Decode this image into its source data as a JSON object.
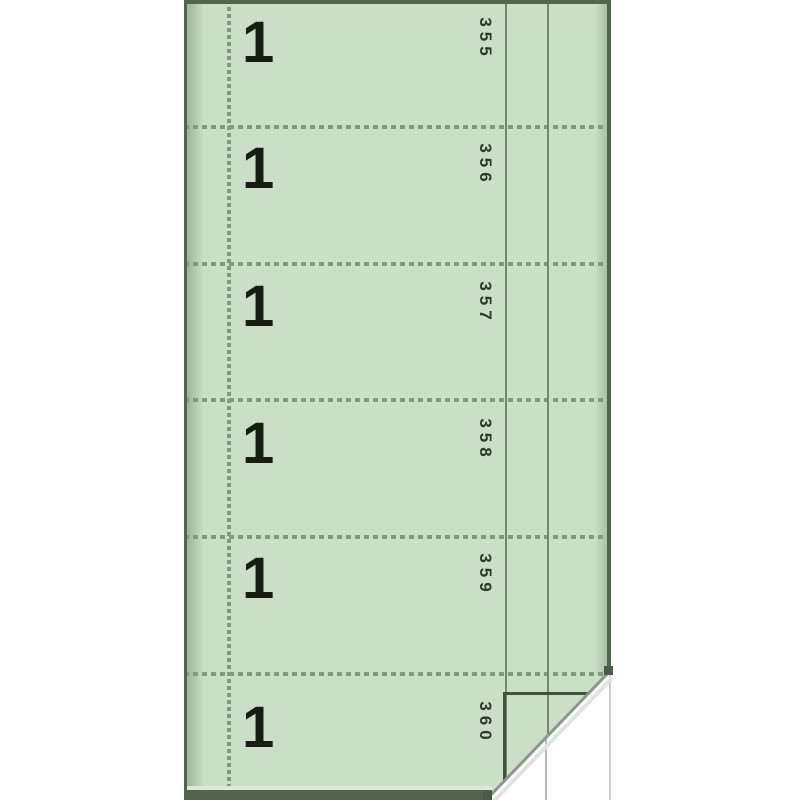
{
  "colors": {
    "background": "#ffffff",
    "paper_green": "#cbdfc8",
    "rule_green": "#74886f",
    "perforation_green": "#84997f",
    "ink_black": "#161e14",
    "photo_edge": "#55644d",
    "curl_white": "#ffffff"
  },
  "form_book": {
    "description": "Green carbonless form book page with six perforated numbered stubs and curled corner showing white duplicate page",
    "sections": [
      {
        "form_number": "1",
        "serial_number": "355"
      },
      {
        "form_number": "1",
        "serial_number": "356"
      },
      {
        "form_number": "1",
        "serial_number": "357"
      },
      {
        "form_number": "1",
        "serial_number": "358"
      },
      {
        "form_number": "1",
        "serial_number": "359"
      },
      {
        "form_number": "1",
        "serial_number": "360"
      }
    ]
  }
}
